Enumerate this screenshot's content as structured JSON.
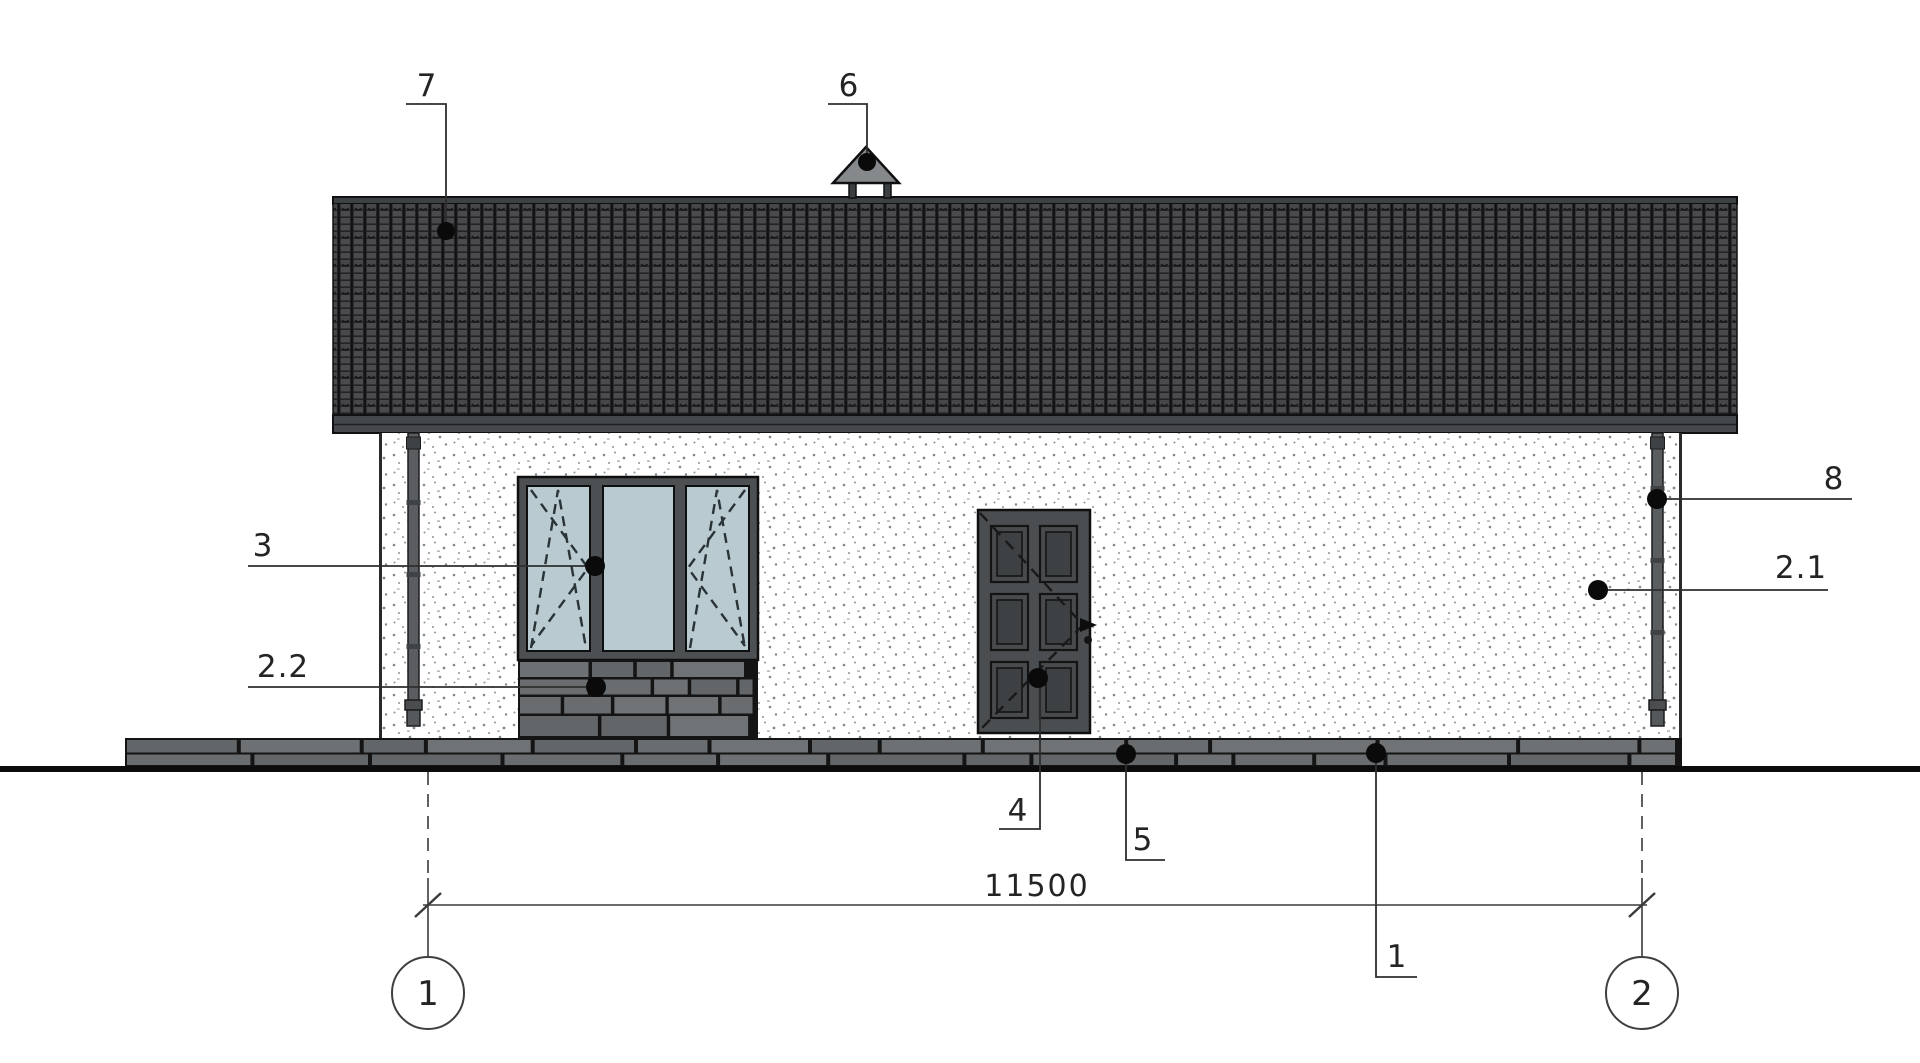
{
  "drawing": {
    "dimension": {
      "value": "11500"
    },
    "axis_bubbles": {
      "left": "1",
      "right": "2"
    },
    "callouts": {
      "roof": "7",
      "roof_vent": "6",
      "window": "3",
      "window_stone_apron": "2.2",
      "downpipe": "8",
      "wall_finish": "2.1",
      "door": "4",
      "plinth": "5",
      "blind_area": "1"
    },
    "colors": {
      "roof_base": "#232325",
      "roof_tile": "#4b4b4d",
      "ridge_cap": "#3e4143",
      "fascia": "#45484a",
      "wall": "#ffffff",
      "stipple": "#82898c",
      "window_frame": "#4d5052",
      "glass": "#b9cbd0",
      "door": "#4a4e50",
      "downpipe": "#5a5e60",
      "stone": "#6a6d6f",
      "joint": "#141414",
      "vent": "#85898b",
      "ink": "#2e2e2e",
      "ground": "#0c0c0c"
    }
  }
}
